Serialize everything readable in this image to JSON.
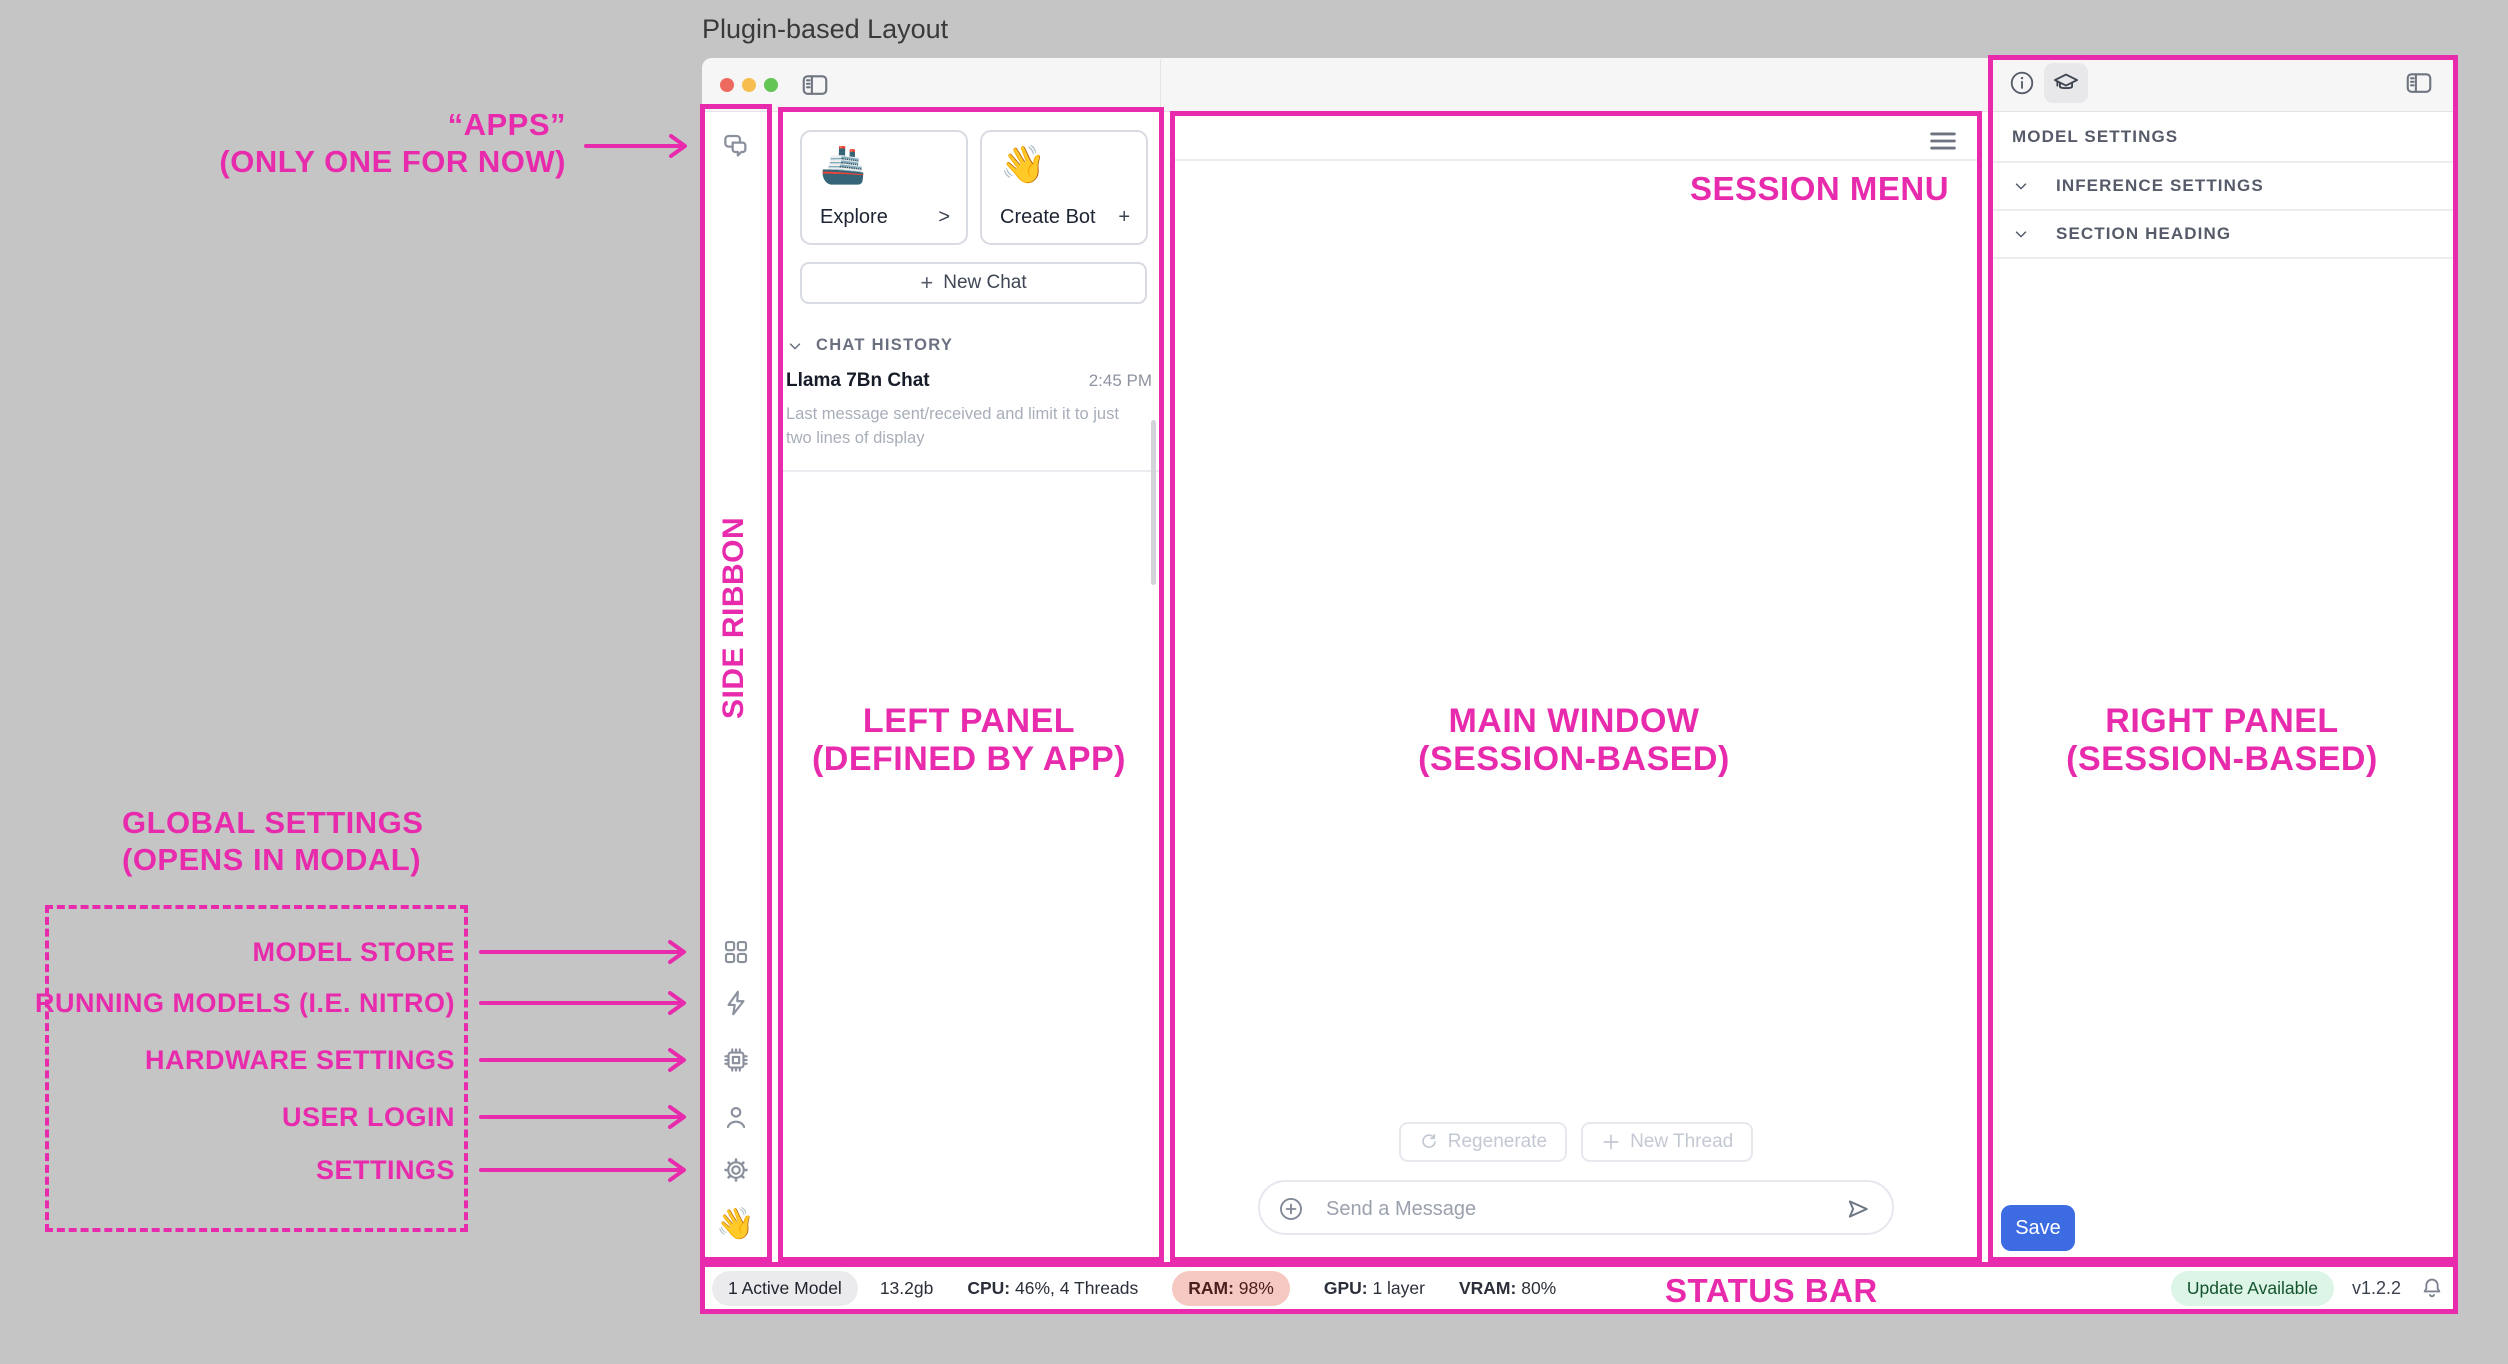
{
  "page_title": "Plugin-based Layout",
  "colors": {
    "annotation_accent": "#E72BAC",
    "save_button": "#3D6BE2",
    "ram_pill_bg": "#F6C8C2",
    "update_pill_bg": "#DCF5E7"
  },
  "annotations": {
    "apps_line1": "“APPS”",
    "apps_line2": "(ONLY ONE FOR NOW)",
    "side_ribbon": "SIDE RIBBON",
    "left_panel_line1": "LEFT PANEL",
    "left_panel_line2": "(DEFINED BY APP)",
    "main_window_line1": "MAIN WINDOW",
    "main_window_line2": "(SESSION-BASED)",
    "right_panel_line1": "RIGHT PANEL",
    "right_panel_line2": "(SESSION-BASED)",
    "session_menu": "SESSION MENU",
    "status_bar": "STATUS BAR",
    "global_settings_line1": "GLOBAL SETTINGS",
    "global_settings_line2": "(OPENS IN MODAL)",
    "ribbon_labels": [
      "MODEL STORE",
      "RUNNING MODELS (I.E. NITRO)",
      "HARDWARE SETTINGS",
      "USER LOGIN",
      "SETTINGS"
    ]
  },
  "ribbon": {
    "app_icon": "chat-bubbles-icon",
    "wave_emoji": "👋"
  },
  "left_panel": {
    "explore_card": {
      "emoji": "🚢",
      "label": "Explore",
      "affordance": ">"
    },
    "create_bot_card": {
      "emoji": "👋",
      "label": "Create Bot",
      "affordance": "+"
    },
    "new_chat": {
      "plus": "+",
      "label": "New Chat"
    },
    "history_header": "CHAT HISTORY",
    "history": [
      {
        "title": "Llama 7Bn Chat",
        "time": "2:45 PM",
        "preview": "Last message sent/received and limit it to just two lines of display"
      }
    ]
  },
  "main_window": {
    "regenerate_label": "Regenerate",
    "new_thread_label": "New Thread",
    "composer_placeholder": "Send a Message"
  },
  "right_panel": {
    "heading": "MODEL SETTINGS",
    "sections": [
      {
        "label": "INFERENCE SETTINGS"
      },
      {
        "label": "SECTION HEADING"
      }
    ],
    "save_label": "Save"
  },
  "status_bar": {
    "active_model": "1 Active Model",
    "memory": "13.2gb",
    "cpu_label": "CPU:",
    "cpu_value": "46%, 4 Threads",
    "ram_label": "RAM:",
    "ram_value": "98%",
    "gpu_label": "GPU:",
    "gpu_value": "1 layer",
    "vram_label": "VRAM:",
    "vram_value": "80%",
    "update_badge": "Update Available",
    "version": "v1.2.2"
  }
}
